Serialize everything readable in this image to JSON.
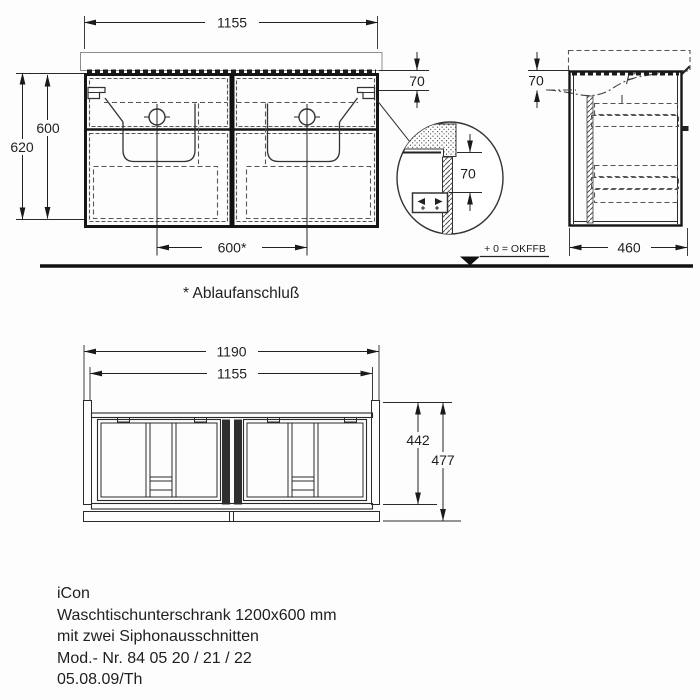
{
  "front_view": {
    "dim_width": "1155",
    "dim_apron": "70",
    "dim_height_inner": "600",
    "dim_height_outer": "620",
    "dim_drain_spacing": "600*"
  },
  "side_view": {
    "dim_apron": "70",
    "dim_depth": "460"
  },
  "detail_view": {
    "dim_offset": "70"
  },
  "plan_view": {
    "dim_width_outer": "1190",
    "dim_width_inner": "1155",
    "dim_depth_inner": "442",
    "dim_depth_outer": "477"
  },
  "annotations": {
    "level_label": "+ 0 = OKFFB",
    "footnote": "* Ablaufanschluß"
  },
  "footer": {
    "lines": [
      "iCon",
      "Waschtischunterschrank 1200x600 mm",
      "mit zwei Siphonausschnitten",
      "Mod.- Nr. 84 05 20 / 21 / 22",
      "05.08.09/Th"
    ]
  },
  "colors": {
    "line": "#1a1a1a",
    "dashed": "#555555",
    "background": "#ffffff"
  }
}
